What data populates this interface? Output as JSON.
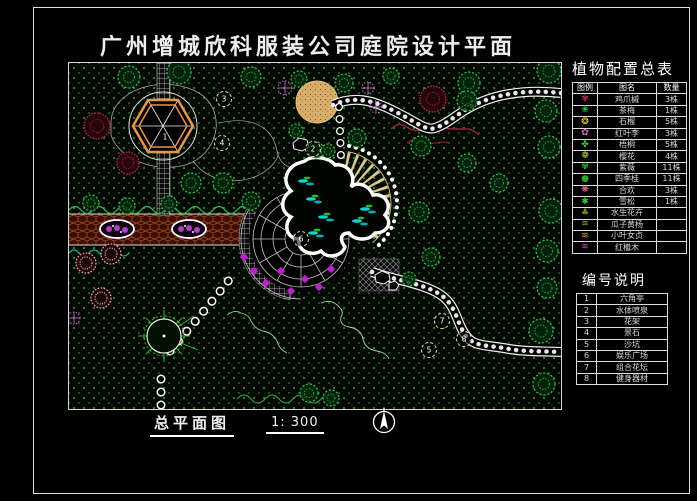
{
  "title": "广州增城欣科服装公司庭院设计平面",
  "footer": {
    "caption": "总平面图",
    "scale": "1: 300"
  },
  "plant_table": {
    "title": "植物配置总表",
    "headers": [
      "图例",
      "图名",
      "数量"
    ],
    "rows": [
      {
        "glyph": "✾",
        "color": "#c03050",
        "name": "鸡爪槭",
        "qty": "3株"
      },
      {
        "glyph": "❀",
        "color": "#30c050",
        "name": "茶梅",
        "qty": "1株"
      },
      {
        "glyph": "❂",
        "color": "#e8e050",
        "name": "石榴",
        "qty": "5株"
      },
      {
        "glyph": "✿",
        "color": "#e868c8",
        "name": "红叶李",
        "qty": "3株"
      },
      {
        "glyph": "✤",
        "color": "#40c840",
        "name": "梧桐",
        "qty": "5株"
      },
      {
        "glyph": "❁",
        "color": "#b8d838",
        "name": "樱花",
        "qty": "4株"
      },
      {
        "glyph": "✾",
        "color": "#30b830",
        "name": "紫薇",
        "qty": "11株"
      },
      {
        "glyph": "●",
        "color": "#28a828",
        "name": "四季桂",
        "qty": "11株"
      },
      {
        "glyph": "❋",
        "color": "#f08898",
        "name": "合欢",
        "qty": "3株"
      },
      {
        "glyph": "✱",
        "color": "#38c838",
        "name": "雪松",
        "qty": "1株"
      },
      {
        "glyph": "♣",
        "color": "#7a8828",
        "name": "水生花卉",
        "qty": ""
      },
      {
        "glyph": "≋",
        "color": "#a0a030",
        "name": "瓜子黄杨",
        "qty": ""
      },
      {
        "glyph": "≋",
        "color": "#e0a030",
        "name": "小叶女贞",
        "qty": ""
      },
      {
        "glyph": "≋",
        "color": "#d048c8",
        "name": "红檵木",
        "qty": ""
      }
    ]
  },
  "legend_table": {
    "title": "编号说明",
    "rows": [
      {
        "no": "1",
        "name": "六角亭"
      },
      {
        "no": "2",
        "name": "水体喷泉"
      },
      {
        "no": "3",
        "name": "花架"
      },
      {
        "no": "4",
        "name": "景石"
      },
      {
        "no": "5",
        "name": "沙坑"
      },
      {
        "no": "6",
        "name": "娱乐广场"
      },
      {
        "no": "7",
        "name": "组合花坛"
      },
      {
        "no": "8",
        "name": "健身器材"
      }
    ]
  },
  "plan": {
    "markers": [
      {
        "x": 96,
        "y": 74,
        "label": "1",
        "ring": false
      },
      {
        "x": 244,
        "y": 86,
        "label": "2",
        "ring": true
      },
      {
        "x": 155,
        "y": 36,
        "label": "3",
        "ring": true
      },
      {
        "x": 153,
        "y": 80,
        "label": "4",
        "ring": true
      },
      {
        "x": 360,
        "y": 287,
        "label": "5",
        "ring": true
      },
      {
        "x": 232,
        "y": 176,
        "label": "6",
        "ring": true
      },
      {
        "x": 373,
        "y": 258,
        "label": "7",
        "ring": true
      },
      {
        "x": 395,
        "y": 276,
        "label": "8",
        "ring": true
      }
    ],
    "trees": [
      [
        60,
        14,
        11
      ],
      [
        110,
        9,
        12
      ],
      [
        182,
        14,
        10
      ],
      [
        230,
        16,
        8
      ],
      [
        275,
        20,
        9
      ],
      [
        322,
        13,
        8
      ],
      [
        400,
        20,
        11
      ],
      [
        398,
        38,
        10
      ],
      [
        480,
        8,
        12
      ],
      [
        477,
        48,
        11
      ],
      [
        480,
        84,
        11
      ],
      [
        482,
        148,
        12
      ],
      [
        478,
        188,
        11
      ],
      [
        478,
        225,
        10
      ],
      [
        472,
        268,
        12
      ],
      [
        475,
        321,
        11
      ],
      [
        430,
        120,
        9
      ],
      [
        350,
        149,
        10
      ],
      [
        362,
        194,
        9
      ],
      [
        340,
        216,
        7
      ],
      [
        288,
        75,
        9
      ],
      [
        352,
        83,
        10
      ],
      [
        398,
        100,
        9
      ],
      [
        247,
        87,
        8
      ],
      [
        227,
        68,
        7
      ],
      [
        259,
        88,
        7
      ],
      [
        122,
        120,
        10
      ],
      [
        154,
        120,
        10
      ],
      [
        182,
        138,
        9
      ],
      [
        240,
        330,
        9
      ],
      [
        262,
        335,
        8
      ],
      [
        22,
        140,
        8
      ],
      [
        58,
        143,
        8
      ],
      [
        100,
        141,
        8
      ]
    ],
    "maples": [
      [
        28,
        63,
        13
      ],
      [
        59,
        100,
        11
      ],
      [
        364,
        36,
        13
      ]
    ],
    "salmon_flowers": [
      [
        17,
        200,
        10
      ],
      [
        42,
        191,
        10
      ],
      [
        32,
        235,
        10
      ]
    ],
    "magenta_stars": [
      [
        216,
        25,
        7
      ],
      [
        299,
        25,
        6
      ],
      [
        307,
        44,
        6
      ],
      [
        5,
        255,
        6
      ]
    ],
    "purple_flowers": [
      [
        175,
        194
      ],
      [
        185,
        208
      ],
      [
        197,
        220
      ],
      [
        212,
        208
      ],
      [
        222,
        228
      ],
      [
        236,
        216
      ],
      [
        250,
        224
      ],
      [
        262,
        206
      ]
    ],
    "water_plants": [
      [
        238,
        118
      ],
      [
        246,
        136
      ],
      [
        258,
        154
      ],
      [
        248,
        170
      ],
      [
        292,
        158
      ],
      [
        300,
        146
      ]
    ],
    "colors": {
      "grass_dot": "#2f8f2f",
      "road": "#3c0e05",
      "sand": "#d9ae6a",
      "fan": "#dcc88e",
      "water": "#00d8d8",
      "pavilion": "#e8954a"
    }
  }
}
